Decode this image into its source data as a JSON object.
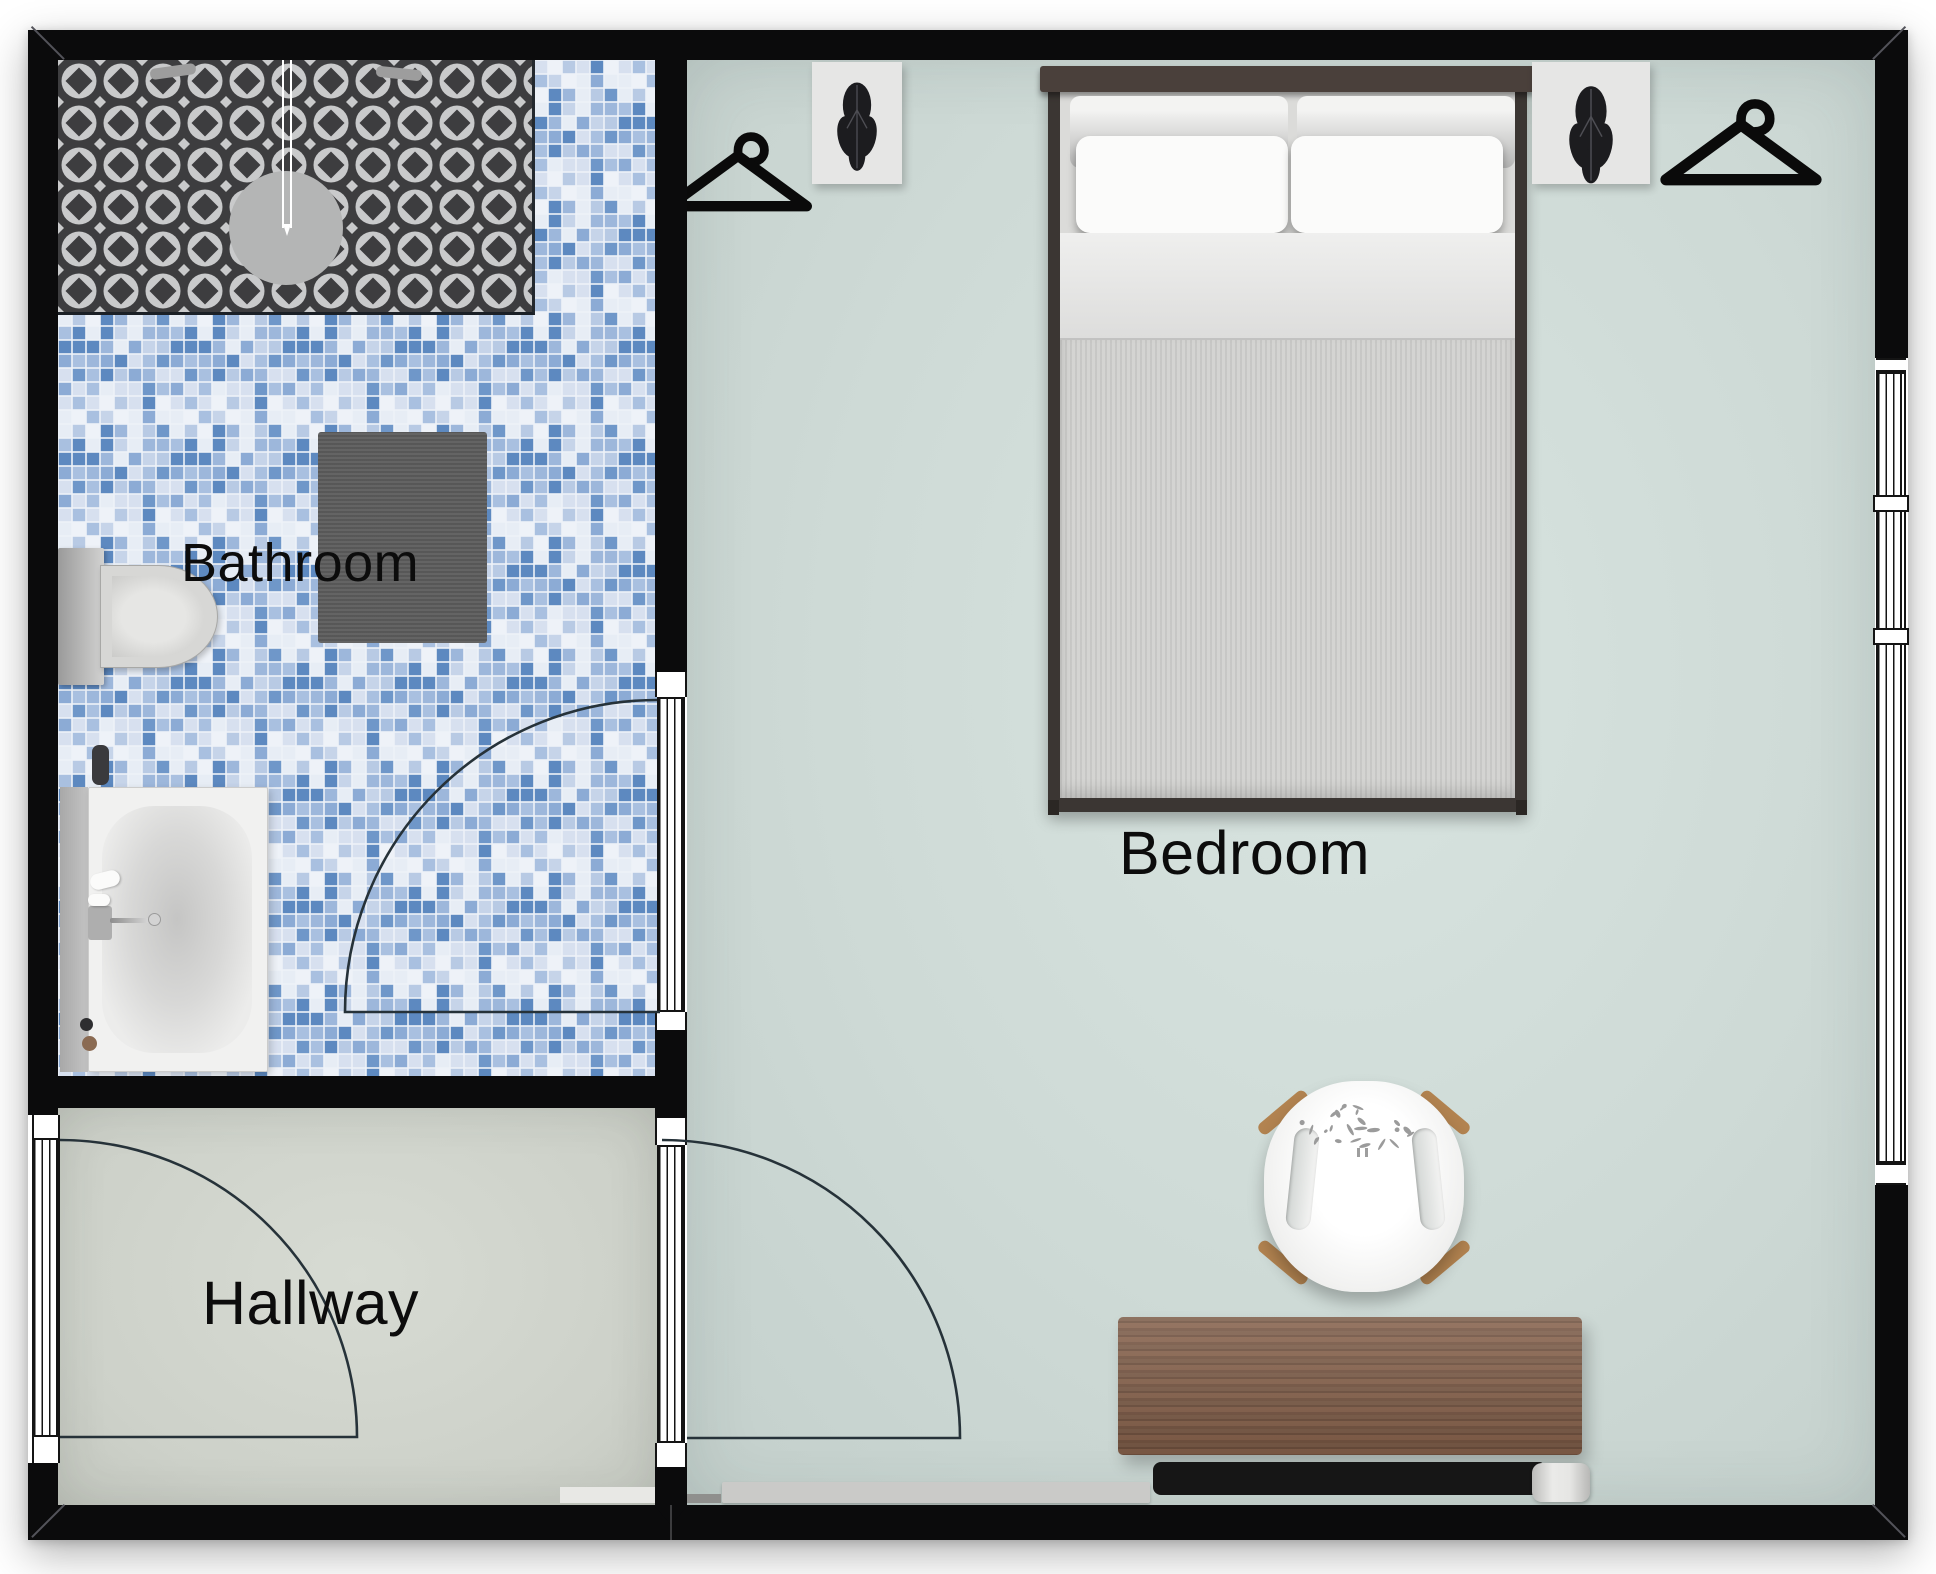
{
  "rooms": {
    "bathroom": {
      "label": "Bathroom"
    },
    "hallway": {
      "label": "Hallway"
    },
    "bedroom": {
      "label": "Bedroom"
    }
  },
  "colors": {
    "wall": "#0b0b0c",
    "bedroom_floor": "#cfdcd8",
    "hallway_floor": "#d2d6ce",
    "shower_tile_dark": "#3d3d3f",
    "shower_tile_light": "#c9cacb",
    "mosaic_blue": "#7fa5d0",
    "bath_mat": "#5c5c5c",
    "desk_wood": "#7b5b47",
    "chair_leg_wood": "#b28350",
    "bed_headboard": "#4a403b"
  },
  "icons": {
    "hanger_left": "hanger-icon",
    "hanger_right": "hanger-icon",
    "plant_left": "plant-icon",
    "plant_right": "plant-icon"
  }
}
